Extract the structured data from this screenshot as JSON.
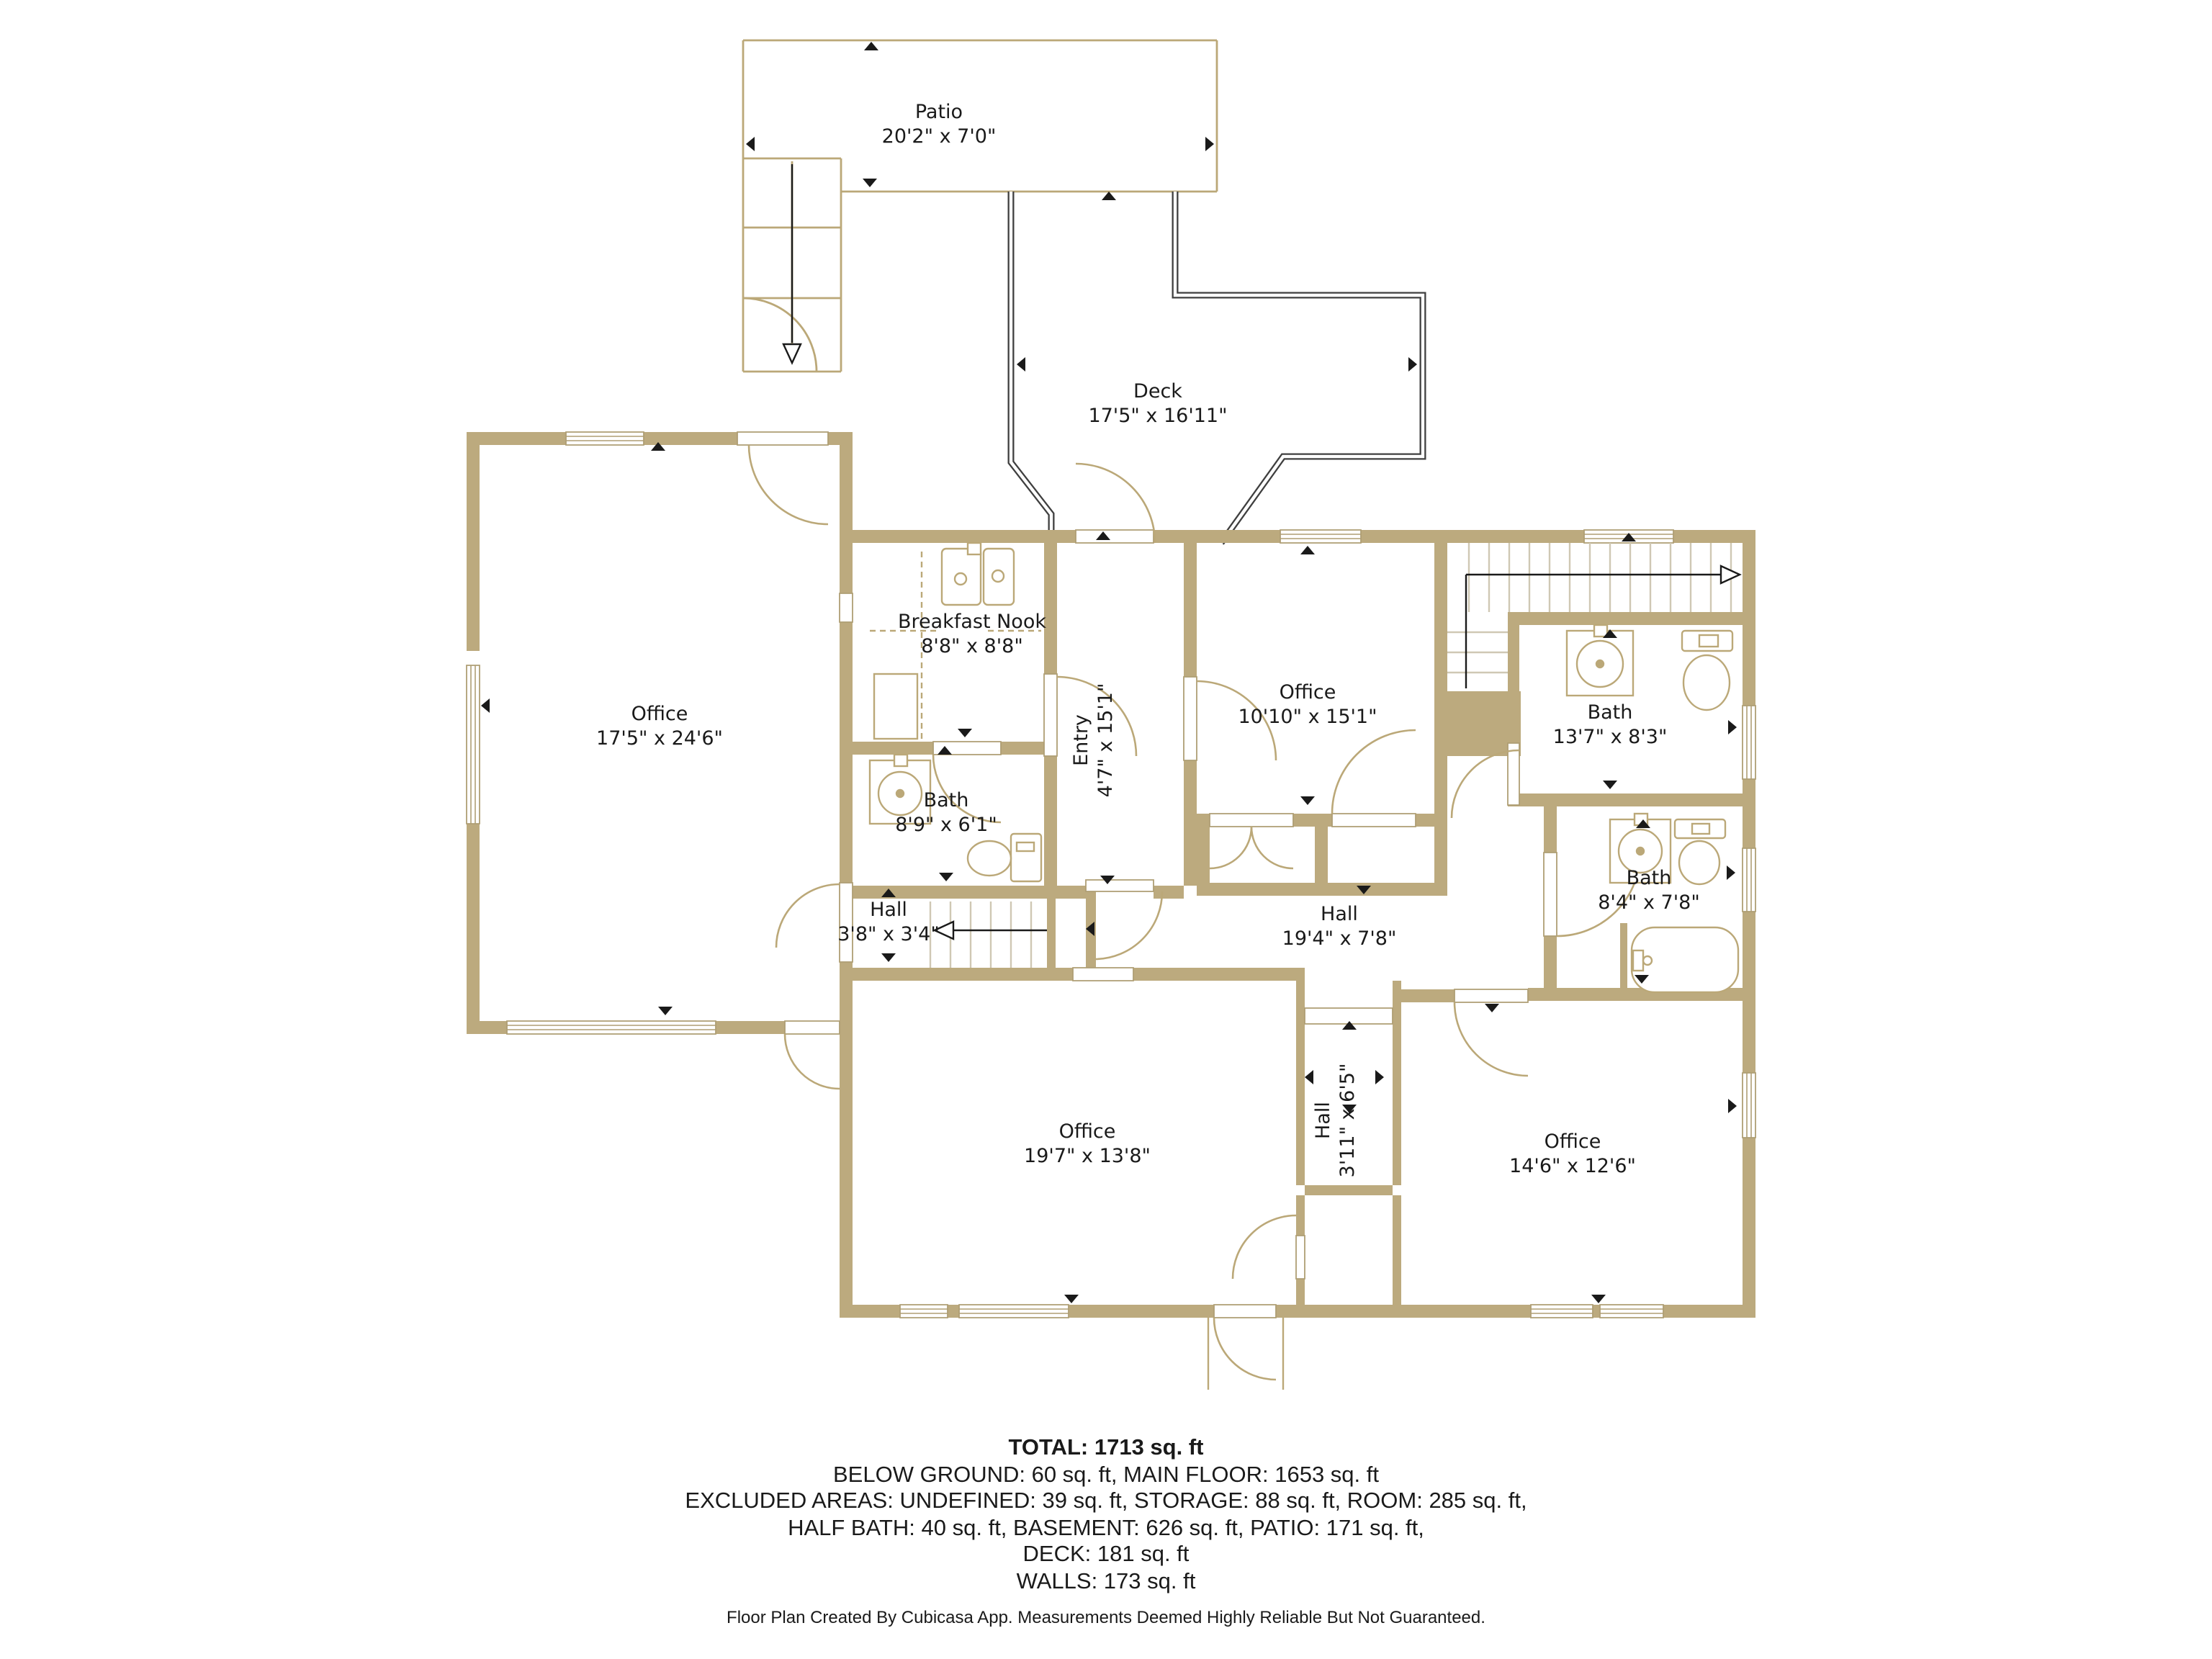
{
  "plan": {
    "rooms": [
      {
        "name": "Patio",
        "dims": "20'2\" x 7'0\""
      },
      {
        "name": "Deck",
        "dims": "17'5\" x 16'11\""
      },
      {
        "name": "Office",
        "dims": "17'5\" x 24'6\""
      },
      {
        "name": "Breakfast Nook",
        "dims": "8'8\" x 8'8\""
      },
      {
        "name": "Entry",
        "dims": "4'7\" x 15'1\""
      },
      {
        "name": "Office",
        "dims": "10'10\" x 15'1\""
      },
      {
        "name": "Bath",
        "dims": "13'7\" x 8'3\""
      },
      {
        "name": "Bath",
        "dims": "8'9\" x 6'1\""
      },
      {
        "name": "Hall",
        "dims": "3'8\" x 3'4\""
      },
      {
        "name": "Hall",
        "dims": "19'4\" x 7'8\""
      },
      {
        "name": "Bath",
        "dims": "8'4\" x 7'8\""
      },
      {
        "name": "Office",
        "dims": "19'7\" x 13'8\""
      },
      {
        "name": "Hall",
        "dims": "3'11\" x 6'5\""
      },
      {
        "name": "Office",
        "dims": "14'6\" x 12'6\""
      }
    ],
    "summary": {
      "total": "TOTAL: 1713 sq. ft",
      "lines": [
        "BELOW GROUND: 60 sq. ft, MAIN FLOOR: 1653 sq. ft",
        "EXCLUDED AREAS: UNDEFINED: 39 sq. ft, STORAGE: 88 sq. ft, ROOM: 285 sq. ft,",
        "HALF BATH: 40 sq. ft, BASEMENT: 626 sq. ft, PATIO: 171 sq. ft,",
        "DECK: 181 sq. ft",
        "WALLS: 173 sq. ft"
      ],
      "footer": "Floor Plan Created By Cubicasa App. Measurements Deemed Highly Reliable But Not Guaranteed."
    },
    "colors": {
      "wall": "#BCAA7E",
      "thin_line": "#BBA878",
      "railing": "#3F3F3F",
      "stair_tread": "#CFC8B4",
      "text": "#1A1A1A",
      "background": "#FFFFFF"
    }
  }
}
